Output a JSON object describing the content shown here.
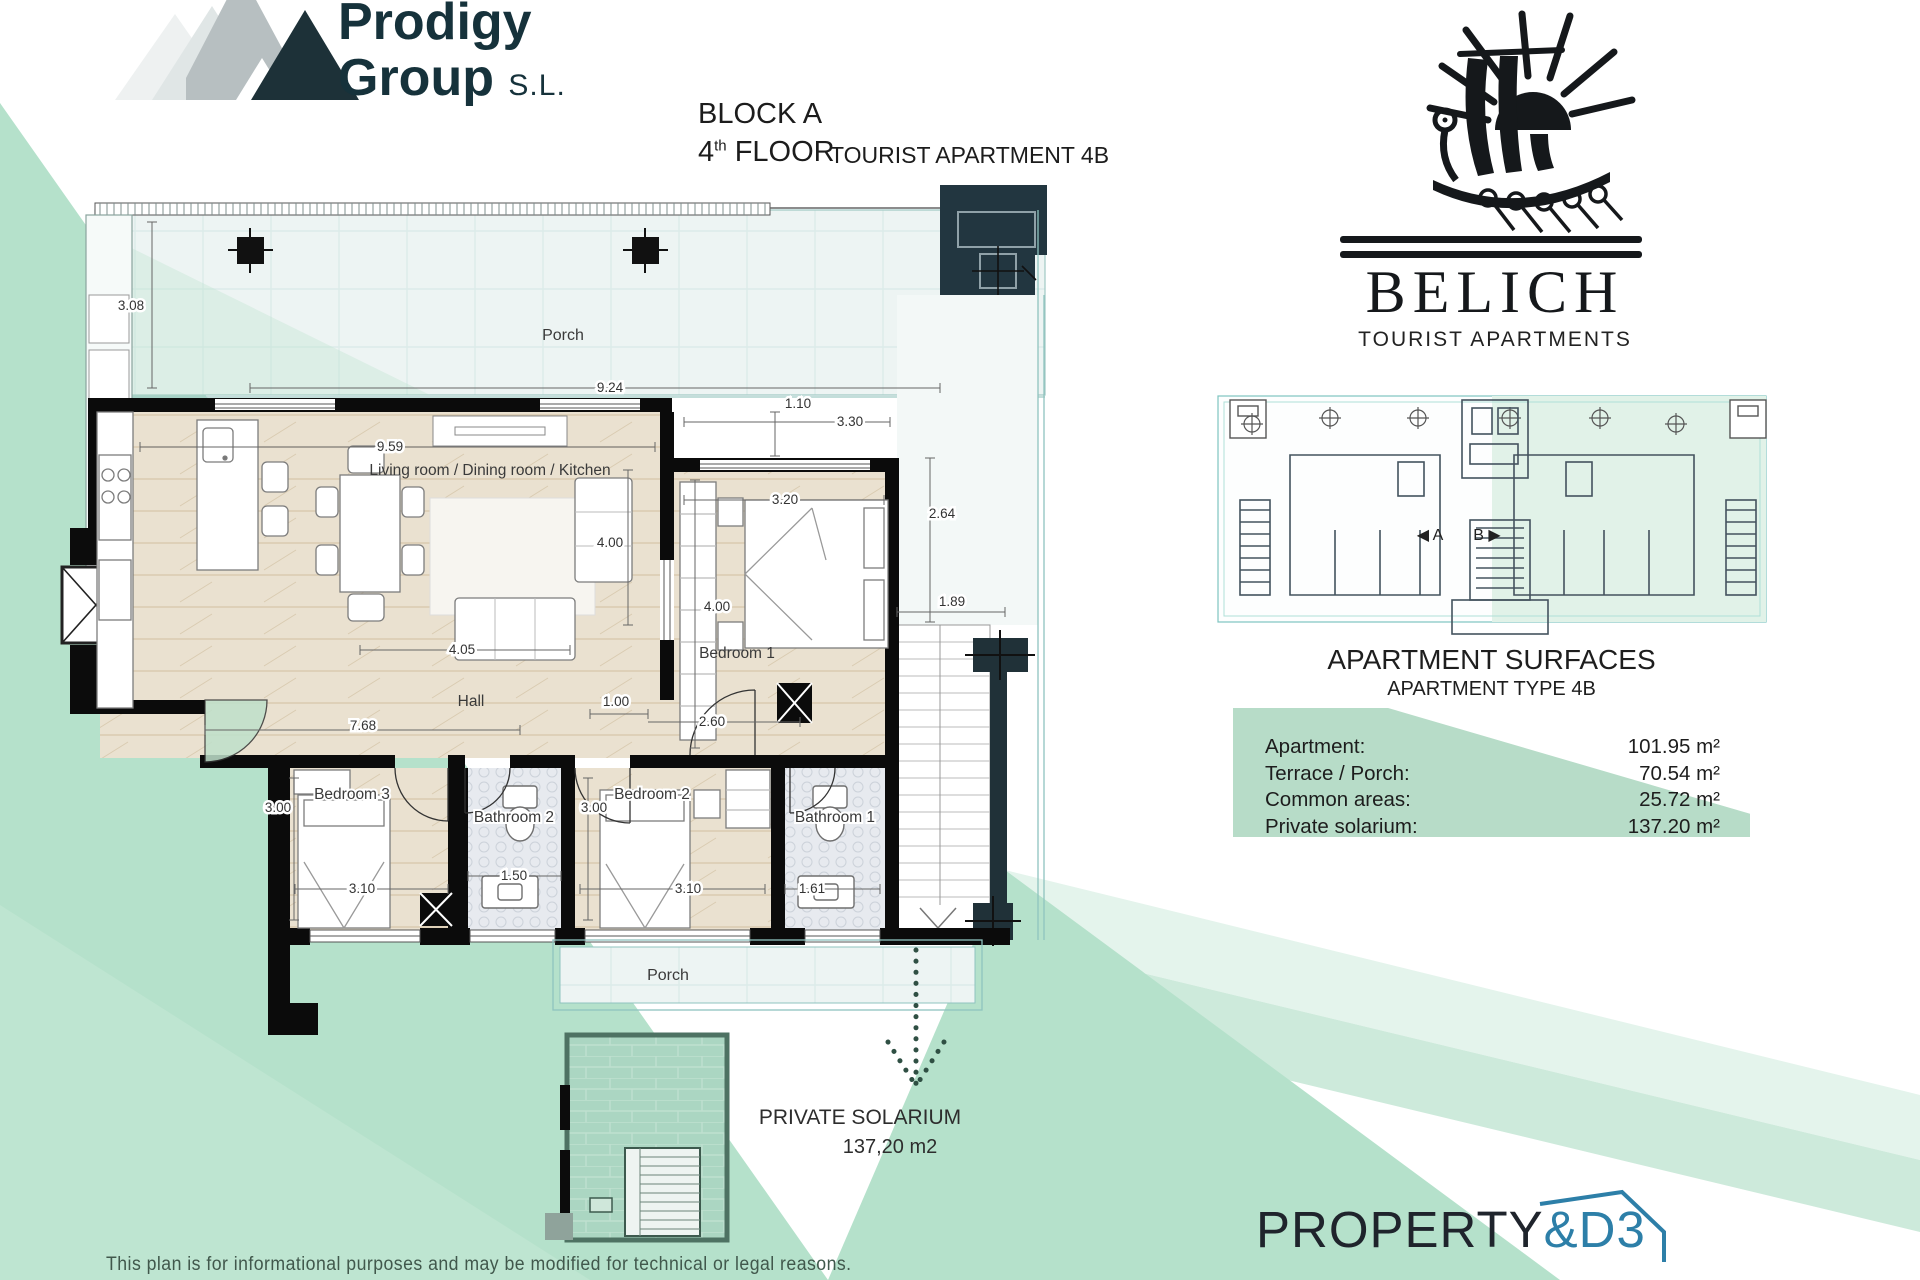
{
  "header": {
    "block": "BLOCK A",
    "floor_number": "4",
    "floor_sup": "th",
    "floor_word": " FLOOR",
    "apartment": "TOURIST APARTMENT 4B"
  },
  "prodigy": {
    "line1": "Prodigy",
    "line2": "Group ",
    "suffix": "S.L."
  },
  "belich": {
    "name": "BELICH",
    "subtitle": "TOURIST APARTMENTS"
  },
  "plan": {
    "rooms": {
      "porch_top": "Porch",
      "living": "Living room / Dining room / Kitchen",
      "bedroom1": "Bedroom 1",
      "hall": "Hall",
      "bedroom3": "Bedroom 3",
      "bathroom2": "Bathroom 2",
      "bedroom2": "Bedroom 2",
      "bathroom1": "Bathroom 1",
      "porch_bottom": "Porch"
    },
    "dims": {
      "porch_height": "3.08",
      "porch_width": "9.24",
      "living_width": "9.59",
      "gap": "1.10",
      "bed1_outer": "3.30",
      "bed1_width": "3.20",
      "terrace_side": "2.64",
      "living_height": "4.00",
      "bed1_height": "4.00",
      "stairs_width": "1.89",
      "sofa_line": "4.05",
      "hall_opening": "1.00",
      "hall_width": "7.68",
      "hall_right": "2.60",
      "bed3_height": "3.00",
      "bed3_width": "3.10",
      "bath2_width": "1.50",
      "bed2_height": "3.00",
      "bed2_width": "3.10",
      "bath1_width": "1.61"
    }
  },
  "overview": {
    "unit_a": "◀ A",
    "unit_b": "B ▶"
  },
  "surfaces": {
    "title": "APARTMENT SURFACES",
    "subtitle": "APARTMENT TYPE 4B",
    "rows": [
      {
        "label": "Apartment:",
        "value": "101.95 m²"
      },
      {
        "label": "Terrace / Porch:",
        "value": "70.54 m²"
      },
      {
        "label": "Common areas:",
        "value": "25.72 m²"
      },
      {
        "label": "Private solarium:",
        "value": "137.20 m²"
      }
    ]
  },
  "solarium": {
    "title": "PRIVATE SOLARIUM",
    "area": "137,20 m2"
  },
  "footer": {
    "disclaimer": "This plan is for informational purposes and may be modified for technical or legal reasons.",
    "brand_left": "PROPERTY",
    "brand_right": "&D3"
  },
  "colors": {
    "mint": "#b5e1cb",
    "dark_teal": "#223640",
    "brand_blue": "#2d7fa8",
    "panel_green": "#b7dcc8"
  }
}
